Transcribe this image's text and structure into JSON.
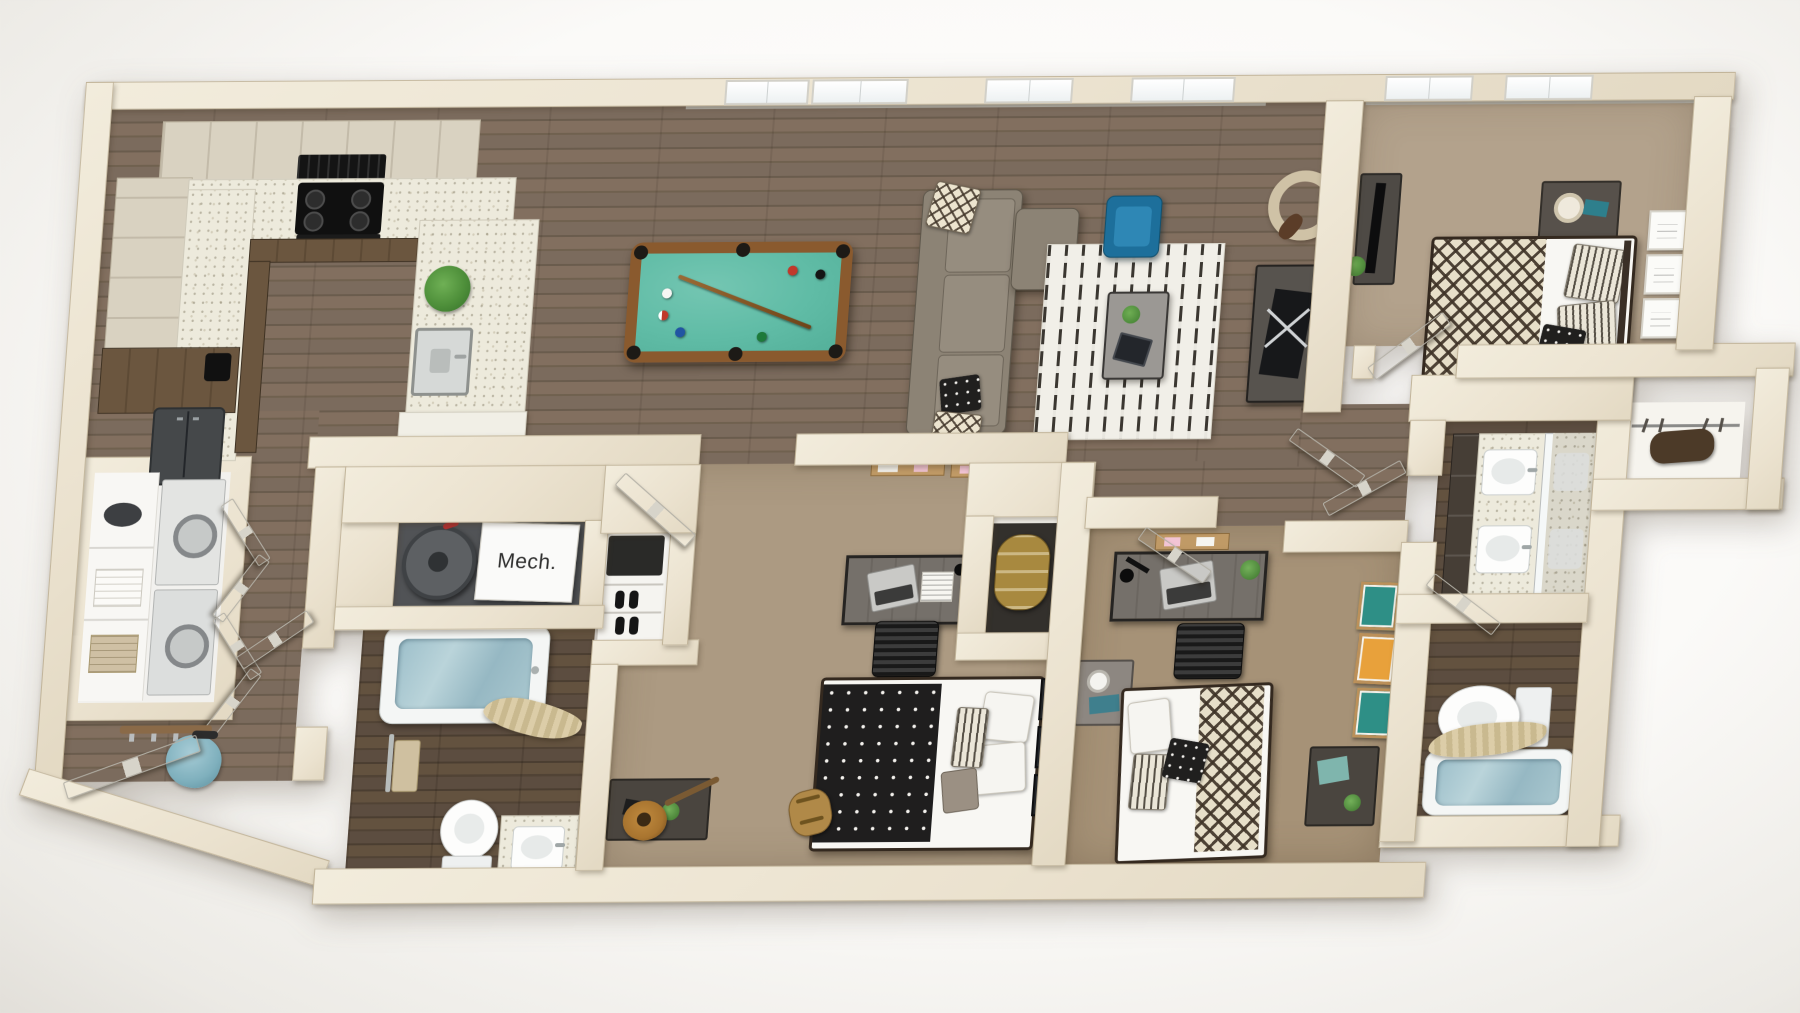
{
  "scene": {
    "type": "3d-floor-plan-render",
    "view": "top-down dollhouse",
    "rooms": [
      "kitchen",
      "living-room",
      "billiards-area",
      "entry-hall",
      "laundry-closet",
      "mechanical-closet",
      "bathroom-1",
      "bedroom-1",
      "bedroom-2",
      "bedroom-3",
      "bathroom-2-double-vanity",
      "bathroom-2-water-closet",
      "walk-in-closet",
      "shoe-closet",
      "storage-closet"
    ]
  },
  "labels": {
    "mech": "Mech."
  },
  "palette": {
    "background": "#fbfaf8",
    "wall_cream": "#ece3cf",
    "wood_floor": "#74655600",
    "wood_floor_main": "#74-6556",
    "wood": "#746556",
    "carpet_tan": "#ac9a82",
    "pool_felt": "#60bca6",
    "pool_rail": "#8a5a2e",
    "sofa_taupe": "#8c8375",
    "accent_chair_blue": "#1e7ca6",
    "rug_white": "#f1efe8",
    "rug_stroke": "#3b3731",
    "duvet_black": "#1f1e1e",
    "throw_diamond_cream": "#e7dfc9",
    "throw_diamond_brown": "#3e3226",
    "tub_water_blue": "#9dbfca",
    "counter_speckle": "#edeadc",
    "cabinet_light_wood": "#d9d2c1",
    "cabinet_dark_wood": "#6b563f",
    "frame_teal": "#2e8f86",
    "frame_orange": "#e8a13b",
    "bag_teal": "#7fb0bd"
  }
}
